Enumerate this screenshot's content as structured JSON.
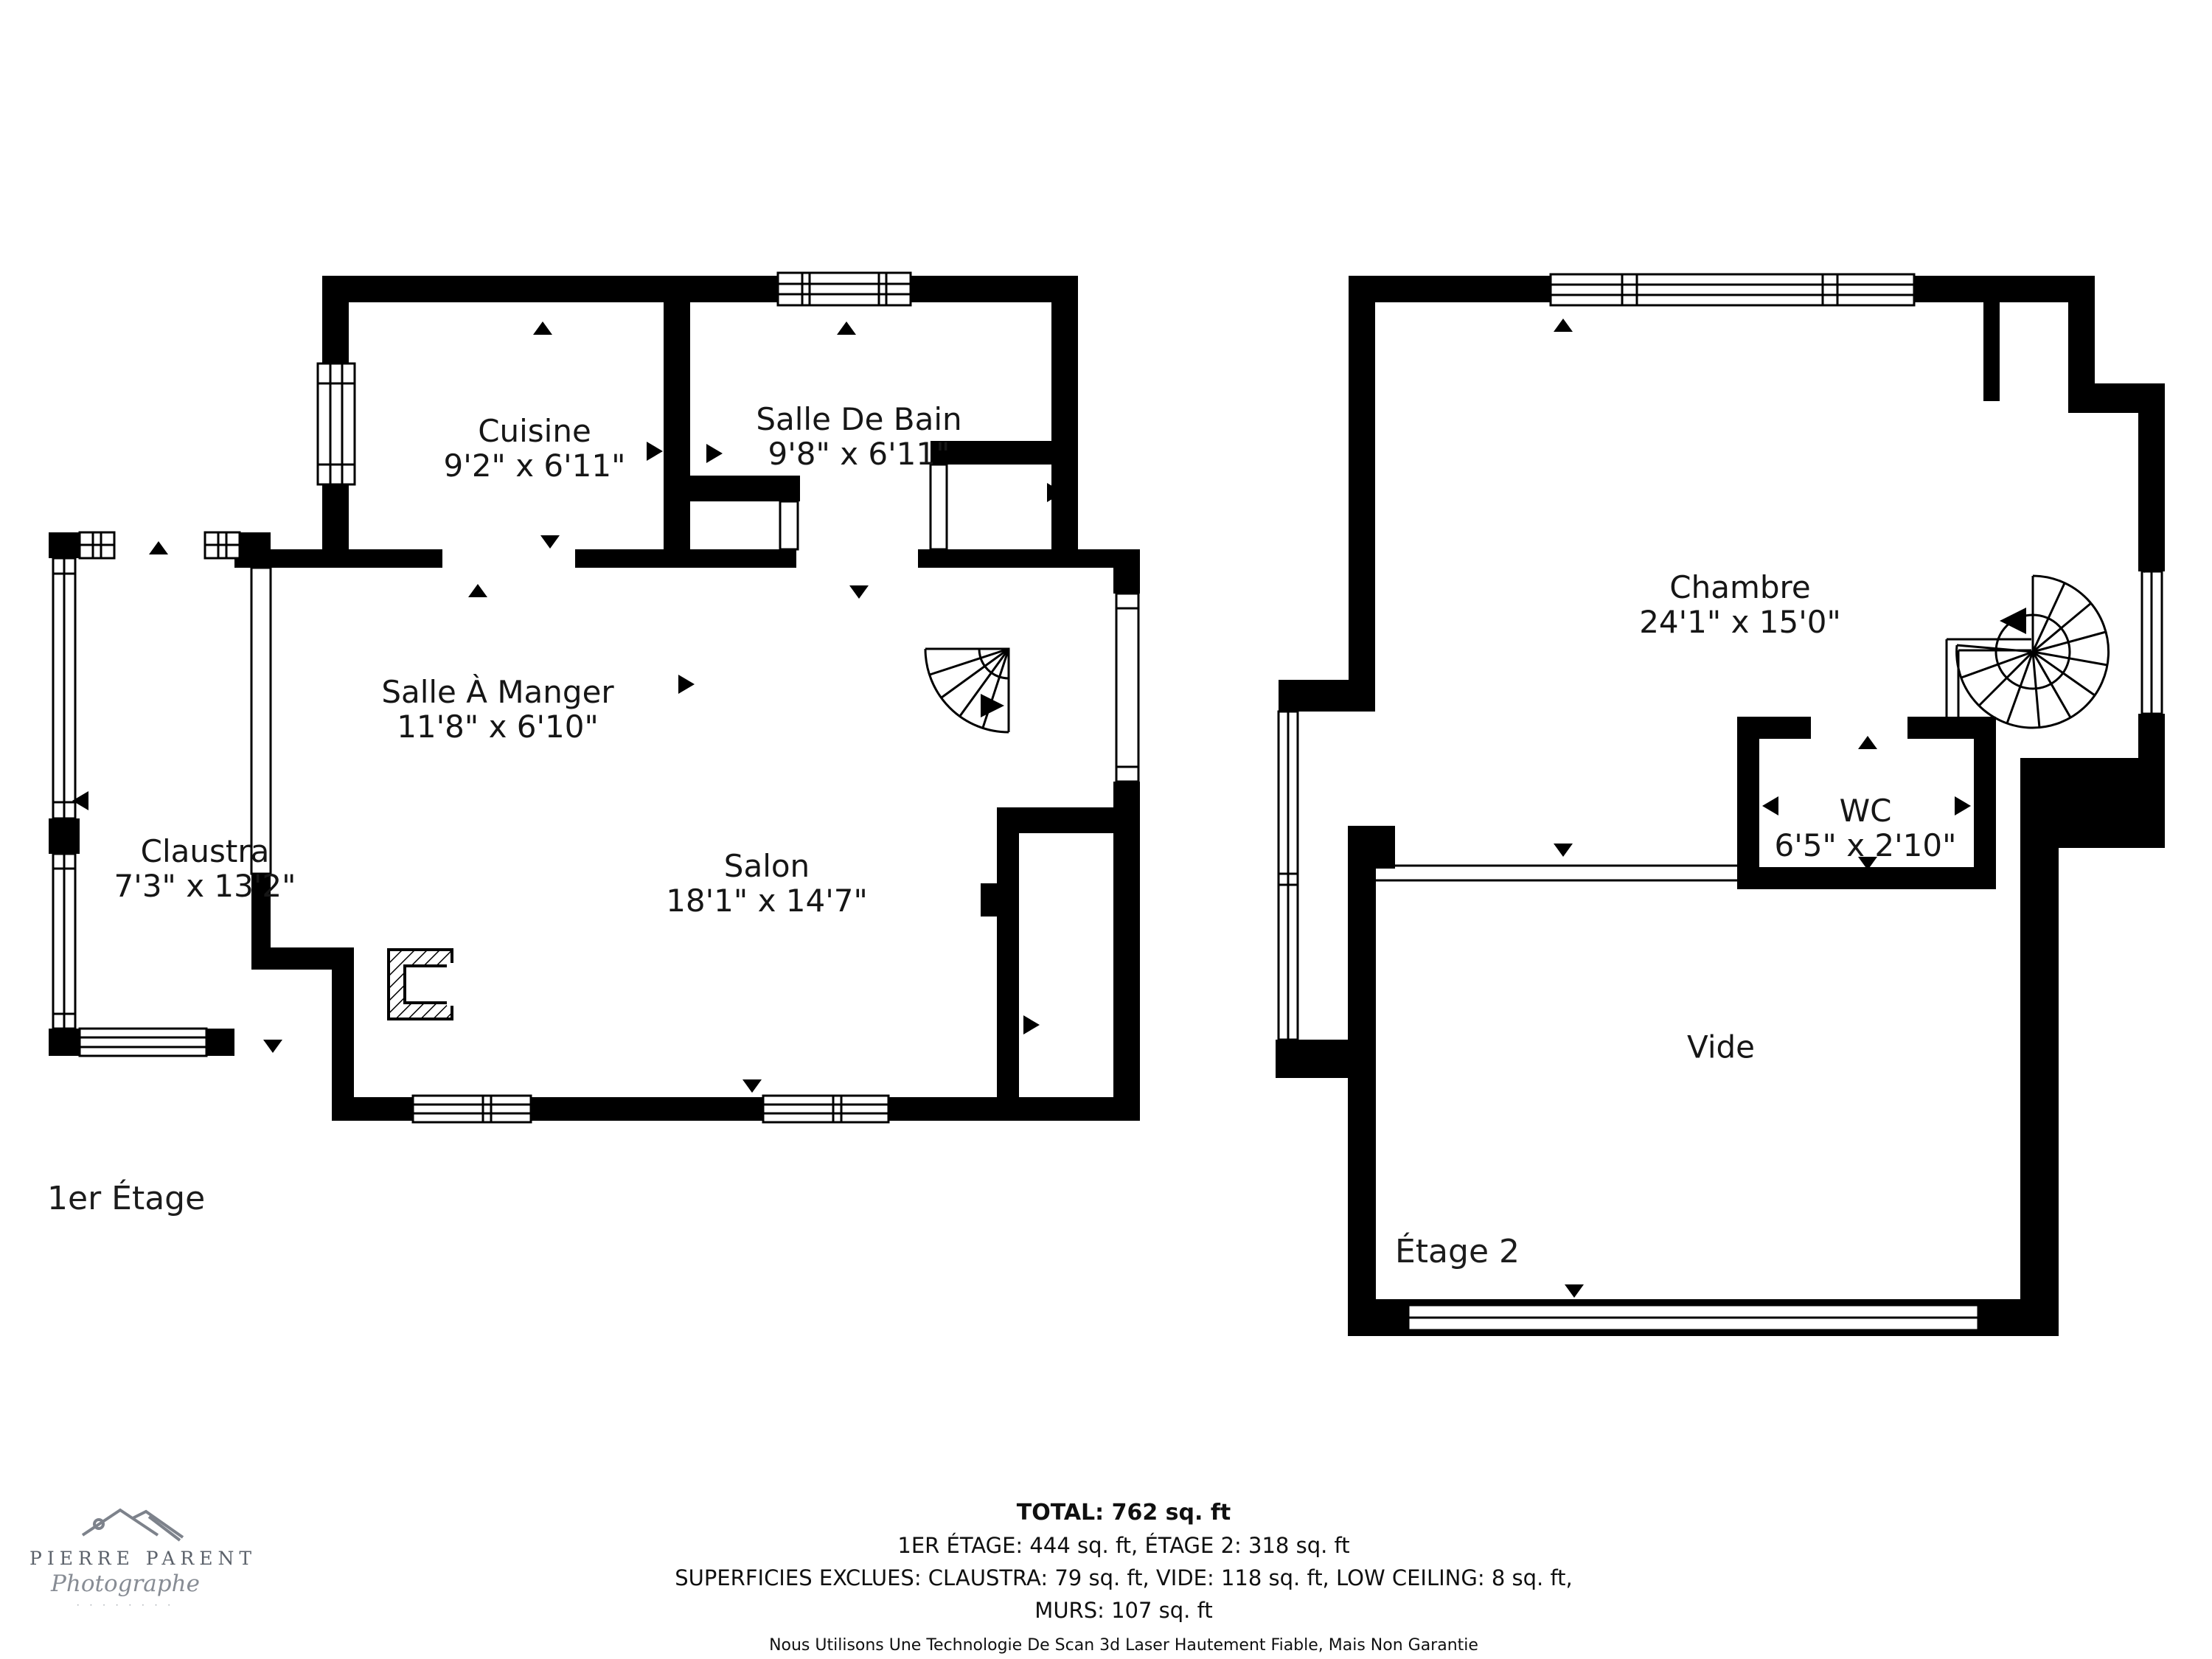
{
  "floor1": {
    "label": "1er Étage",
    "rooms": [
      {
        "name": "Cuisine",
        "dims": "9'2\" x 6'11\""
      },
      {
        "name": "Salle De Bain",
        "dims": "9'8\" x 6'11\""
      },
      {
        "name": "Salle À Manger",
        "dims": "11'8\" x 6'10\""
      },
      {
        "name": "Claustra",
        "dims": "7'3\" x 13'2\""
      },
      {
        "name": "Salon",
        "dims": "18'1\" x 14'7\""
      }
    ]
  },
  "floor2": {
    "label": "Étage 2",
    "rooms": [
      {
        "name": "Chambre",
        "dims": "24'1\" x 15'0\""
      },
      {
        "name": "WC",
        "dims": "6'5\" x 2'10\""
      },
      {
        "name": "Vide",
        "dims": ""
      }
    ]
  },
  "summary": {
    "total": "TOTAL: 762 sq. ft",
    "floors": "1ER ÉTAGE: 444 sq. ft, ÉTAGE 2: 318 sq. ft",
    "exclusions": "SUPERFICIES EXCLUES: CLAUSTRA: 79 sq. ft, VIDE: 118 sq. ft, LOW CEILING: 8 sq. ft,",
    "walls": "MURS: 107 sq. ft",
    "disclaimer": "Nous Utilisons Une Technologie De Scan 3d Laser Hautement Fiable, Mais Non Garantie"
  },
  "logo": {
    "name": "PIERRE PARENT",
    "subtitle": "Photographe",
    "tagline": "· · · · · · · ·"
  },
  "colors": {
    "wall": "#000000",
    "background": "#ffffff",
    "logo_gray": "#6e747d"
  }
}
